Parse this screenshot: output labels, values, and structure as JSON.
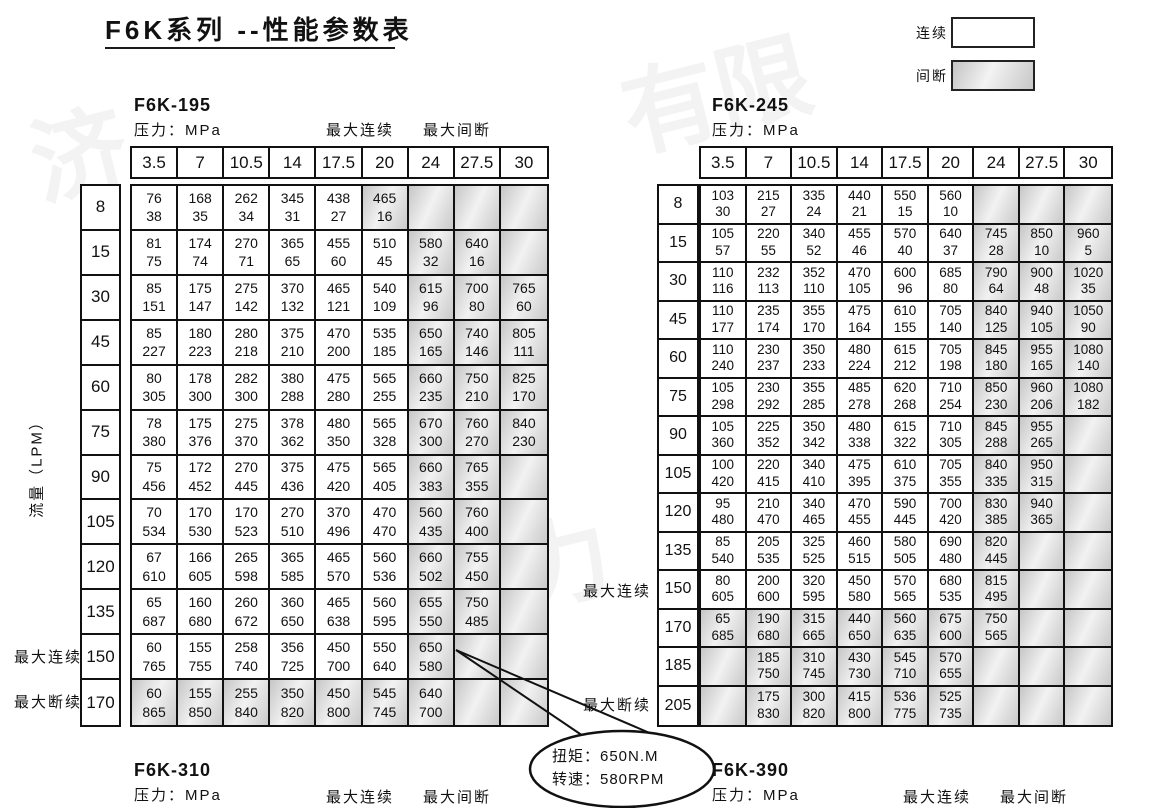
{
  "title": "F6K系列 --性能参数表",
  "watermark": {
    "text": "济宁力顺液压有限公司",
    "chars": [
      "济",
      "液压",
      "有限",
      "公司",
      "宁力",
      "顺液"
    ]
  },
  "legend": {
    "continuous": "连续",
    "intermittent": "间断"
  },
  "labels": {
    "pressure": "压力：MPa",
    "max_continuous": "最大连续",
    "max_intermittent": "最大间断",
    "max_discontinuous": "最大断续",
    "flow_axis": "流量（LPM）"
  },
  "callout": {
    "line1": "扭矩：650N.M",
    "line2": "转速：580RPM"
  },
  "tables": [
    {
      "model": "F6K-195",
      "pressure_label": "压力：MPa",
      "columns": [
        "3.5",
        "7",
        "10.5",
        "14",
        "17.5",
        "20",
        "24",
        "27.5",
        "30"
      ],
      "flows": [
        "8",
        "15",
        "30",
        "45",
        "60",
        "75",
        "90",
        "105",
        "120",
        "135",
        "150",
        "170"
      ],
      "rows": [
        [
          [
            76,
            38
          ],
          [
            168,
            35
          ],
          [
            262,
            34
          ],
          [
            345,
            31
          ],
          [
            438,
            27
          ],
          [
            465,
            16
          ],
          null,
          null,
          null
        ],
        [
          [
            81,
            75
          ],
          [
            174,
            74
          ],
          [
            270,
            71
          ],
          [
            365,
            65
          ],
          [
            455,
            60
          ],
          [
            510,
            45
          ],
          [
            580,
            32
          ],
          [
            640,
            16
          ],
          null
        ],
        [
          [
            85,
            151
          ],
          [
            175,
            147
          ],
          [
            275,
            142
          ],
          [
            370,
            132
          ],
          [
            465,
            121
          ],
          [
            540,
            109
          ],
          [
            615,
            96
          ],
          [
            700,
            80
          ],
          [
            765,
            60
          ]
        ],
        [
          [
            85,
            227
          ],
          [
            180,
            223
          ],
          [
            280,
            218
          ],
          [
            375,
            210
          ],
          [
            470,
            200
          ],
          [
            535,
            185
          ],
          [
            650,
            165
          ],
          [
            740,
            146
          ],
          [
            805,
            111
          ]
        ],
        [
          [
            80,
            305
          ],
          [
            178,
            300
          ],
          [
            282,
            300
          ],
          [
            380,
            288
          ],
          [
            475,
            280
          ],
          [
            565,
            255
          ],
          [
            660,
            235
          ],
          [
            750,
            210
          ],
          [
            825,
            170
          ]
        ],
        [
          [
            78,
            380
          ],
          [
            175,
            376
          ],
          [
            275,
            370
          ],
          [
            378,
            362
          ],
          [
            480,
            350
          ],
          [
            565,
            328
          ],
          [
            670,
            300
          ],
          [
            760,
            270
          ],
          [
            840,
            230
          ]
        ],
        [
          [
            75,
            456
          ],
          [
            172,
            452
          ],
          [
            270,
            445
          ],
          [
            375,
            436
          ],
          [
            475,
            420
          ],
          [
            565,
            405
          ],
          [
            660,
            383
          ],
          [
            765,
            355
          ],
          null
        ],
        [
          [
            70,
            534
          ],
          [
            170,
            530
          ],
          [
            170,
            523
          ],
          [
            270,
            510
          ],
          [
            370,
            496
          ],
          [
            470,
            470
          ],
          [
            560,
            435
          ],
          [
            760,
            400
          ],
          null
        ],
        [
          [
            67,
            610
          ],
          [
            166,
            605
          ],
          [
            265,
            598
          ],
          [
            365,
            585
          ],
          [
            465,
            570
          ],
          [
            560,
            536
          ],
          [
            660,
            502
          ],
          [
            755,
            450
          ],
          null
        ],
        [
          [
            65,
            687
          ],
          [
            160,
            680
          ],
          [
            260,
            672
          ],
          [
            360,
            650
          ],
          [
            465,
            638
          ],
          [
            560,
            595
          ],
          [
            655,
            550
          ],
          [
            750,
            485
          ],
          null
        ],
        [
          [
            60,
            765
          ],
          [
            155,
            755
          ],
          [
            258,
            740
          ],
          [
            356,
            725
          ],
          [
            450,
            700
          ],
          [
            550,
            640
          ],
          [
            650,
            580
          ],
          null,
          null
        ],
        [
          [
            60,
            865
          ],
          [
            155,
            850
          ],
          [
            255,
            840
          ],
          [
            350,
            820
          ],
          [
            450,
            800
          ],
          [
            545,
            745
          ],
          [
            640,
            700
          ],
          null,
          null
        ]
      ],
      "gray_columns_from": 6,
      "gray_full_rows": [
        11
      ],
      "extra_gray_cells": [
        [
          0,
          5
        ]
      ]
    },
    {
      "model": "F6K-245",
      "pressure_label": "压力：MPa",
      "columns": [
        "3.5",
        "7",
        "10.5",
        "14",
        "17.5",
        "20",
        "24",
        "27.5",
        "30"
      ],
      "flows": [
        "8",
        "15",
        "30",
        "45",
        "60",
        "75",
        "90",
        "105",
        "120",
        "135",
        "150",
        "170",
        "185",
        "205"
      ],
      "rows": [
        [
          [
            103,
            30
          ],
          [
            215,
            27
          ],
          [
            335,
            24
          ],
          [
            440,
            21
          ],
          [
            550,
            15
          ],
          [
            560,
            10
          ],
          null,
          null,
          null
        ],
        [
          [
            105,
            57
          ],
          [
            220,
            55
          ],
          [
            340,
            52
          ],
          [
            455,
            46
          ],
          [
            570,
            40
          ],
          [
            640,
            37
          ],
          [
            745,
            28
          ],
          [
            850,
            10
          ],
          [
            960,
            5
          ]
        ],
        [
          [
            110,
            116
          ],
          [
            232,
            113
          ],
          [
            352,
            110
          ],
          [
            470,
            105
          ],
          [
            600,
            96
          ],
          [
            685,
            80
          ],
          [
            790,
            64
          ],
          [
            900,
            48
          ],
          [
            1020,
            35
          ]
        ],
        [
          [
            110,
            177
          ],
          [
            235,
            174
          ],
          [
            355,
            170
          ],
          [
            475,
            164
          ],
          [
            610,
            155
          ],
          [
            705,
            140
          ],
          [
            840,
            125
          ],
          [
            940,
            105
          ],
          [
            1050,
            90
          ]
        ],
        [
          [
            110,
            240
          ],
          [
            230,
            237
          ],
          [
            350,
            233
          ],
          [
            480,
            224
          ],
          [
            615,
            212
          ],
          [
            705,
            198
          ],
          [
            845,
            180
          ],
          [
            955,
            165
          ],
          [
            1080,
            140
          ]
        ],
        [
          [
            105,
            298
          ],
          [
            230,
            292
          ],
          [
            355,
            285
          ],
          [
            485,
            278
          ],
          [
            620,
            268
          ],
          [
            710,
            254
          ],
          [
            850,
            230
          ],
          [
            960,
            206
          ],
          [
            1080,
            182
          ]
        ],
        [
          [
            105,
            360
          ],
          [
            225,
            352
          ],
          [
            350,
            342
          ],
          [
            480,
            338
          ],
          [
            615,
            322
          ],
          [
            710,
            305
          ],
          [
            845,
            288
          ],
          [
            955,
            265
          ],
          null
        ],
        [
          [
            100,
            420
          ],
          [
            220,
            415
          ],
          [
            340,
            410
          ],
          [
            475,
            395
          ],
          [
            610,
            375
          ],
          [
            705,
            355
          ],
          [
            840,
            335
          ],
          [
            950,
            315
          ],
          null
        ],
        [
          [
            95,
            480
          ],
          [
            210,
            470
          ],
          [
            340,
            465
          ],
          [
            470,
            455
          ],
          [
            590,
            445
          ],
          [
            700,
            420
          ],
          [
            830,
            385
          ],
          [
            940,
            365
          ],
          null
        ],
        [
          [
            85,
            540
          ],
          [
            205,
            535
          ],
          [
            325,
            525
          ],
          [
            460,
            515
          ],
          [
            580,
            505
          ],
          [
            690,
            480
          ],
          [
            820,
            445
          ],
          null,
          null
        ],
        [
          [
            80,
            605
          ],
          [
            200,
            600
          ],
          [
            320,
            595
          ],
          [
            450,
            580
          ],
          [
            570,
            565
          ],
          [
            680,
            535
          ],
          [
            815,
            495
          ],
          null,
          null
        ],
        [
          [
            65,
            685
          ],
          [
            190,
            680
          ],
          [
            315,
            665
          ],
          [
            440,
            650
          ],
          [
            560,
            635
          ],
          [
            675,
            600
          ],
          [
            750,
            565
          ],
          null,
          null
        ],
        [
          null,
          [
            185,
            750
          ],
          [
            310,
            745
          ],
          [
            430,
            730
          ],
          [
            545,
            710
          ],
          [
            570,
            655
          ],
          null,
          null,
          null
        ],
        [
          null,
          [
            175,
            830
          ],
          [
            300,
            820
          ],
          [
            415,
            800
          ],
          [
            536,
            775
          ],
          [
            525,
            735
          ],
          null,
          null,
          null
        ]
      ],
      "gray_columns_from": 6,
      "gray_full_rows": [
        11,
        12,
        13
      ],
      "extra_gray_cells": []
    }
  ],
  "footer": {
    "left_model": "F6K-310",
    "right_model": "F6K-390",
    "pressure": "压力：MPa",
    "max_continuous": "最大连续",
    "max_intermittent": "最大间断"
  }
}
